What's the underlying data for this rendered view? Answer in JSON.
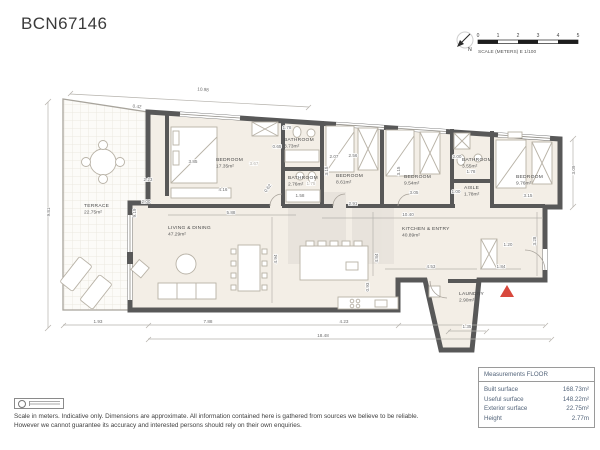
{
  "title": "BCN67146",
  "compass": {
    "north_label": "N"
  },
  "scale_bar": {
    "ticks": [
      "0",
      "1",
      "2",
      "3",
      "4",
      "5"
    ],
    "label": "SCALE (METERS) E 1/100"
  },
  "plan": {
    "rooms": [
      {
        "name": "TERRACE",
        "area": "22.75m²",
        "x": 84,
        "y": 207
      },
      {
        "name": "BEDROOM",
        "area": "17.35m²",
        "x": 216,
        "y": 161
      },
      {
        "name": "BATHROOM",
        "area": "3.73m²",
        "x": 284,
        "y": 141
      },
      {
        "name": "BATHROOM",
        "area": "2.76m²",
        "x": 288,
        "y": 179
      },
      {
        "name": "BEDROOM",
        "area": "8.61m²",
        "x": 336,
        "y": 177
      },
      {
        "name": "BEDROOM",
        "area": "9.54m²",
        "x": 404,
        "y": 178
      },
      {
        "name": "BATHROOM",
        "area": "3.55m²",
        "x": 462,
        "y": 161
      },
      {
        "name": "AISLE",
        "area": "1.78m²",
        "x": 464,
        "y": 189
      },
      {
        "name": "BEDROOM",
        "area": "9.76m²",
        "x": 516,
        "y": 178
      },
      {
        "name": "LIVING & DINING",
        "area": "47.29m²",
        "x": 168,
        "y": 229
      },
      {
        "name": "KITCHEN & ENTRY",
        "area": "40.89m²",
        "x": 402,
        "y": 230
      },
      {
        "name": "LAUNDRY",
        "area": "2.90m²",
        "x": 459,
        "y": 295
      }
    ],
    "dimensions": [
      {
        "t": "10.98",
        "x": 203,
        "y": 91,
        "r": 4
      },
      {
        "t": "0.42",
        "x": 137,
        "y": 108,
        "r": 4
      },
      {
        "t": "9.81",
        "x": 50,
        "y": 212,
        "r": -90
      },
      {
        "t": "2.23",
        "x": 148,
        "y": 181
      },
      {
        "t": "2.00",
        "x": 146,
        "y": 203
      },
      {
        "t": "9.19",
        "x": 136,
        "y": 213,
        "r": -90
      },
      {
        "t": "3.85",
        "x": 193,
        "y": 163
      },
      {
        "t": "3.67",
        "x": 254,
        "y": 165,
        "c": 1
      },
      {
        "t": "4.16",
        "x": 223,
        "y": 191
      },
      {
        "t": "5.88",
        "x": 231,
        "y": 214
      },
      {
        "t": "1.78",
        "x": 287,
        "y": 129
      },
      {
        "t": "0.65",
        "x": 277,
        "y": 148
      },
      {
        "t": "2.07",
        "x": 334,
        "y": 158
      },
      {
        "t": "2.56",
        "x": 353,
        "y": 157
      },
      {
        "t": "1.75",
        "x": 311,
        "y": 185,
        "c": 1
      },
      {
        "t": "1.58",
        "x": 300,
        "y": 197
      },
      {
        "t": "0.62",
        "x": 269,
        "y": 189,
        "r": -55
      },
      {
        "t": "3.15",
        "x": 328,
        "y": 171,
        "r": -90
      },
      {
        "t": "2.91",
        "x": 353,
        "y": 205
      },
      {
        "t": "3.15",
        "x": 400,
        "y": 171,
        "r": -90
      },
      {
        "t": "3.05",
        "x": 414,
        "y": 194
      },
      {
        "t": "2.00",
        "x": 457,
        "y": 158
      },
      {
        "t": "1.78",
        "x": 471,
        "y": 173
      },
      {
        "t": "1.00",
        "x": 456,
        "y": 193
      },
      {
        "t": "3.15",
        "x": 528,
        "y": 197
      },
      {
        "t": "3.09",
        "x": 575,
        "y": 170,
        "r": -90
      },
      {
        "t": "10.40",
        "x": 408,
        "y": 216
      },
      {
        "t": "4.94",
        "x": 277,
        "y": 259,
        "r": -90
      },
      {
        "t": "4.84",
        "x": 378,
        "y": 258,
        "r": -90
      },
      {
        "t": "4.53",
        "x": 431,
        "y": 268
      },
      {
        "t": "1.84",
        "x": 501,
        "y": 268
      },
      {
        "t": "1.20",
        "x": 508,
        "y": 246
      },
      {
        "t": "3.28",
        "x": 536,
        "y": 241,
        "r": -90
      },
      {
        "t": "0.93",
        "x": 369,
        "y": 287,
        "r": -90
      },
      {
        "t": "1.93",
        "x": 98,
        "y": 323
      },
      {
        "t": "7.88",
        "x": 208,
        "y": 323
      },
      {
        "t": "4.23",
        "x": 344,
        "y": 323
      },
      {
        "t": "18.48",
        "x": 323,
        "y": 337
      },
      {
        "t": "1.35",
        "x": 467,
        "y": 328
      }
    ]
  },
  "measurements": {
    "header": "Measurements FLOOR",
    "rows": [
      {
        "label": "Built surface",
        "value": "168.73m²"
      },
      {
        "label": "Useful surface",
        "value": "148.22m²"
      },
      {
        "label": "Exterior surface",
        "value": "22.75m²"
      },
      {
        "label": "Height",
        "value": "2.77m"
      }
    ]
  },
  "footer": {
    "disclaimer_line1": "Scale in meters. Indicative only. Dimensions are approximate. All information contained here is gathered from sources we believe to be reliable.",
    "disclaimer_line2": "However we cannot guarantee its accuracy and interested persons should rely on their own enquiries."
  }
}
